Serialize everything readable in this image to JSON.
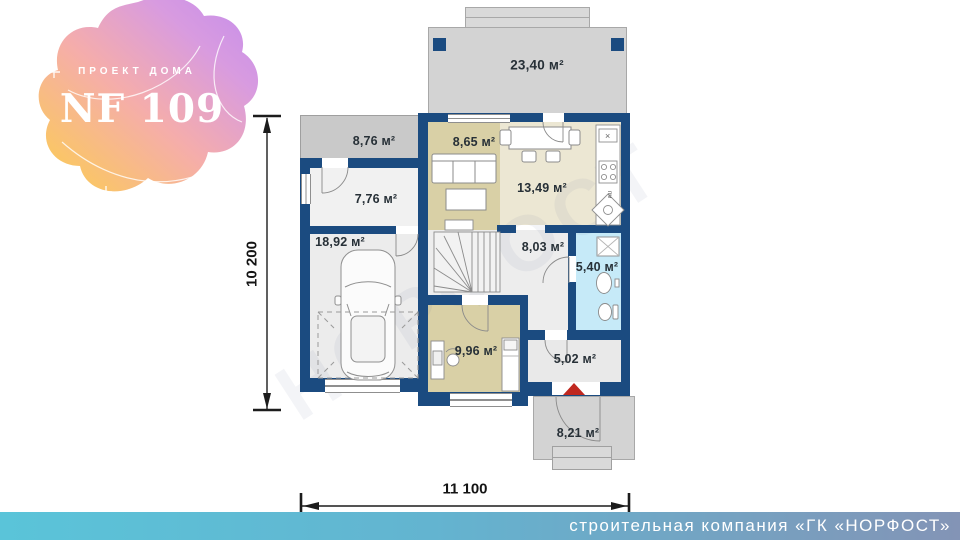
{
  "logo": {
    "tagline": "ПРОЕКТ ДОМА",
    "title": "NF 109"
  },
  "plan": {
    "rooms": {
      "terrace": "23,40 м²",
      "balcony": "8,76 м²",
      "hall_776": "7,76 м²",
      "garage": "18,92 м²",
      "living": "8,65 м²",
      "kitchen_dining": "13,49 м²",
      "hall": "8,03 м²",
      "bathroom": "5,40 м²",
      "cabinet": "9,96 м²",
      "entry": "5,02 м²",
      "porch": "8,21 м²"
    },
    "dimensions": {
      "height": "10 200",
      "width": "11 100"
    },
    "kitchen": {
      "marker": "×",
      "dishwasher_label": "пм"
    },
    "watermark": "НОРФОСТ"
  },
  "footer": {
    "company": "строительная компания «ГК «НОРФОСТ»"
  },
  "colors": {
    "wall": "#1b4b80",
    "terrace_fill": "#d3d3d3",
    "room_beige": "#d9d0a6",
    "room_cream": "#ece7d3",
    "bathroom_blue": "#c6eaf8",
    "floor_gray": "#ededed",
    "entrance_arrow_red": "#c0281f",
    "footer_gradient_start": "#5ac4d9",
    "footer_gradient_end": "#8394b6",
    "logo_yellow": "#fccf4d",
    "logo_pink": "#f5adab",
    "logo_purple": "#c38cec"
  }
}
